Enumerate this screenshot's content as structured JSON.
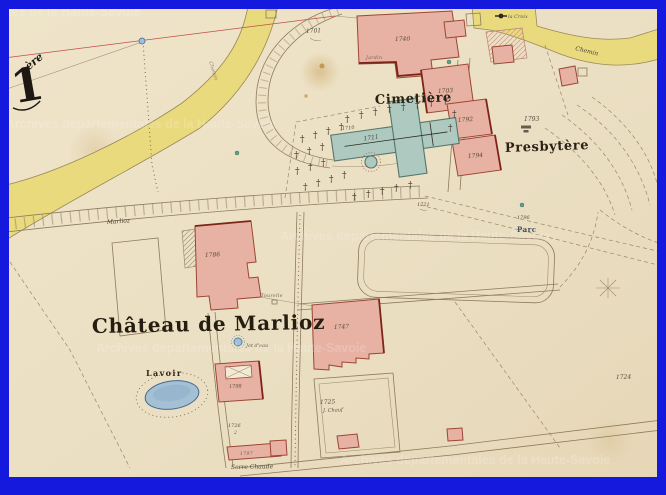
{
  "map": {
    "sheet": {
      "numeral": "1",
      "suffix": "ère"
    },
    "watermark": "Archives départementales de la Haute-Savoie",
    "labels": {
      "cimetiere": "Cimetière",
      "presbytere": "Presbytère",
      "chateau": "Château de Marlioz",
      "jet_deau": "Jet d'eau",
      "lavoir": "Lavoir",
      "serre_chaude": "Serre Chaude",
      "road_marlioz": "Marlioz",
      "chemin": "Chemin",
      "chemin2": "Chemin",
      "la_croix": "la Croix",
      "parc": "Parc",
      "jardin": "Jardin",
      "tourelle": "Tourelle",
      "annex_1725_note": "J. Chauf",
      "note_1726": "2"
    },
    "parcels": {
      "p1701": "1701",
      "p1703": "1703",
      "p1710": "1710",
      "p1711": "1711",
      "p1721": "1721",
      "p1724": "1724",
      "p1725": "1725",
      "p1726": "1726",
      "p1740": "1740",
      "p1747": "1747",
      "p1786": "1786",
      "p1792": "1792",
      "p1793": "1793",
      "p1794": "1794",
      "p1796": "1796",
      "p1797": "1797",
      "p1798": "1798"
    },
    "colors": {
      "border": "#1518dd",
      "paper": "#ebdfc3",
      "building": "#e7b2a4",
      "building_outline": "#9c4534",
      "church": "#aec9bf",
      "road": "#e9da7e",
      "water": "#a3c0d4",
      "ink": "#54483a"
    }
  },
  "icons": {
    "grave_cross": "†"
  }
}
